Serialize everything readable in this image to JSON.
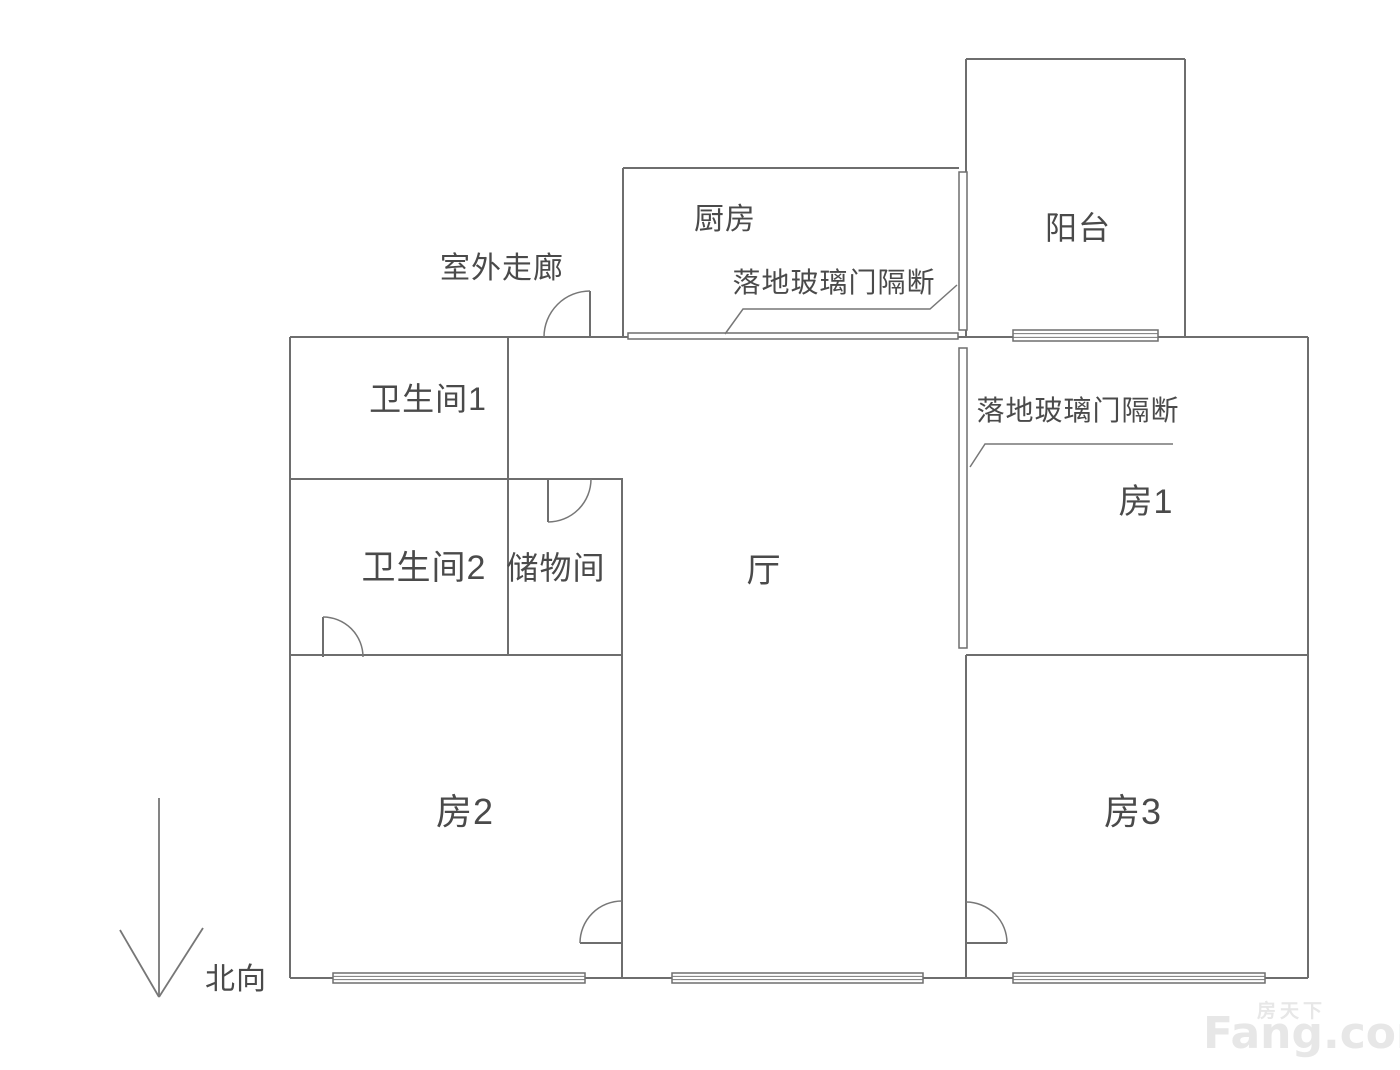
{
  "plan": {
    "style": {
      "wall_color": "#6e6e6e",
      "thin_color": "#777777",
      "text_color": "#4a4a4a",
      "watermark_color": "#e7e7e7",
      "background": "#ffffff"
    },
    "walls": [
      [
        290,
        337,
        1308,
        337
      ],
      [
        290,
        978,
        1308,
        978
      ],
      [
        290,
        337,
        290,
        978
      ],
      [
        1308,
        337,
        1308,
        978
      ],
      [
        623,
        168,
        623,
        337
      ],
      [
        623,
        168,
        959,
        168
      ],
      [
        966,
        59,
        966,
        337
      ],
      [
        966,
        59,
        1185,
        59
      ],
      [
        1185,
        59,
        1185,
        337
      ],
      [
        508,
        337,
        508,
        655
      ],
      [
        290,
        479,
        623,
        479
      ],
      [
        622,
        479,
        622,
        978
      ],
      [
        290,
        655,
        622,
        655
      ],
      [
        966,
        655,
        1308,
        655
      ],
      [
        966,
        655,
        966,
        978
      ]
    ],
    "glass_partitions": [
      {
        "x": 959,
        "y": 172,
        "w": 8,
        "h": 158
      },
      {
        "x": 959,
        "y": 348,
        "w": 8,
        "h": 300
      },
      {
        "x": 628,
        "y": 333,
        "w": 330,
        "h": 6
      }
    ],
    "windows": [
      {
        "x": 1013,
        "y": 330,
        "w": 145,
        "h": 11
      },
      {
        "x": 333,
        "y": 973,
        "w": 252,
        "h": 10
      },
      {
        "x": 672,
        "y": 973,
        "w": 251,
        "h": 10
      },
      {
        "x": 1013,
        "y": 973,
        "w": 252,
        "h": 10
      }
    ],
    "doors": [
      {
        "name": "entry-door",
        "leaf": [
          590,
          291,
          590,
          337
        ],
        "arc": "M590,291 A46,46 0 0 0 544,337"
      },
      {
        "name": "storage-door",
        "leaf": [
          548,
          479,
          548,
          522
        ],
        "arc": "M548,522 A43,43 0 0 0 591,479"
      },
      {
        "name": "bath2-door",
        "leaf": [
          323,
          617,
          323,
          657
        ],
        "arc": "M323,617 A40,40 0 0 1 363,657"
      },
      {
        "name": "room2-door",
        "leaf": [
          580,
          943,
          622,
          943
        ],
        "arc": "M580,943 A42,42 0 0 1 622,901"
      },
      {
        "name": "room3-door",
        "leaf": [
          966,
          943,
          1007,
          943
        ],
        "arc": "M1007,943 A41,41 0 0 0 966,902"
      }
    ],
    "leader_lines": [
      {
        "name": "glass-label-leader-1",
        "points": "725,334 743,309 930,309 957,285"
      },
      {
        "name": "glass-label-leader-2",
        "points": "970,467 985,444 1173,444"
      }
    ],
    "north_arrow": {
      "shaft": [
        159,
        798,
        159,
        997
      ],
      "arms": [
        [
          120,
          930,
          159,
          997
        ],
        [
          203,
          928,
          159,
          997
        ]
      ]
    },
    "labels": {
      "corridor": {
        "text": "室外走廊",
        "x": 502,
        "y": 269,
        "size": 30
      },
      "kitchen": {
        "text": "厨房",
        "x": 725,
        "y": 220,
        "size": 30
      },
      "glass1": {
        "text": "落地玻璃门隔断",
        "x": 834,
        "y": 283,
        "size": 28
      },
      "balcony": {
        "text": "阳台",
        "x": 1078,
        "y": 228,
        "size": 32
      },
      "glass2": {
        "text": "落地玻璃门隔断",
        "x": 1078,
        "y": 411,
        "size": 28
      },
      "bath1": {
        "text": "卫生间1",
        "x": 428,
        "y": 399,
        "size": 32
      },
      "bath2": {
        "text": "卫生间2",
        "x": 424,
        "y": 568,
        "size": 34
      },
      "storage": {
        "text": "储物间",
        "x": 556,
        "y": 568,
        "size": 32
      },
      "hall": {
        "text": "厅",
        "x": 764,
        "y": 571,
        "size": 34
      },
      "room1": {
        "text": "房1",
        "x": 1146,
        "y": 502,
        "size": 34
      },
      "room2": {
        "text": "房2",
        "x": 465,
        "y": 812,
        "size": 36
      },
      "room3": {
        "text": "房3",
        "x": 1133,
        "y": 812,
        "size": 36
      },
      "north": {
        "text": "北向",
        "x": 236,
        "y": 980,
        "size": 30
      }
    },
    "watermark": {
      "main": "Fang.com",
      "sub": "房天下"
    }
  }
}
